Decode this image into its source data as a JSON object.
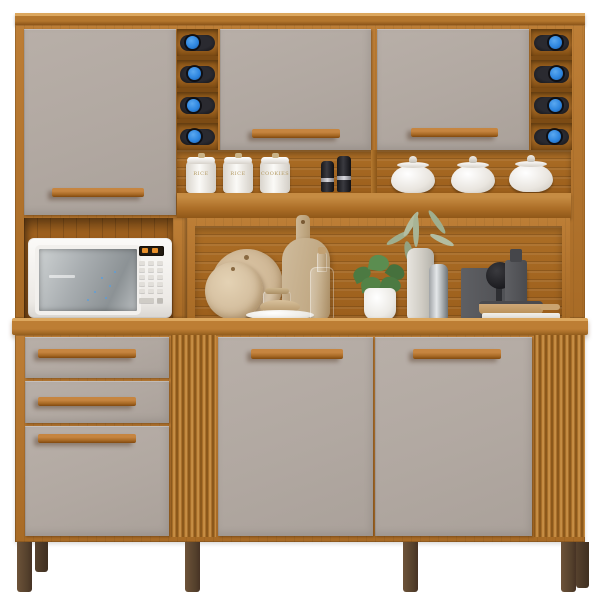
{
  "scene": {
    "type": "furniture product photo",
    "subject": "Kitchen hutch cabinet with wine racks, microwave niche and decor",
    "background_color": "#ffffff"
  },
  "palette": {
    "wood": "#ae7029",
    "wood_light": "#d39c52",
    "wood_dark": "#7d4e16",
    "front_gray": "#b1a8a1",
    "handle_wood": "#a96a26",
    "leg_brown": "#54402c",
    "wine_cap_blue": "#2e86e0",
    "ceramic_white": "#f5f3ef",
    "microwave_white": "#f4f2ef"
  },
  "counts": {
    "upper_doors": 3,
    "lower_doors": 2,
    "drawers": 3,
    "wine_bottles_left": 4,
    "wine_bottles_right": 4,
    "canisters": 3,
    "lidded_pots": 3,
    "spice_grinders": 2,
    "legs_visible": 6
  },
  "labels": {
    "canisters": [
      "RICE",
      "RICE",
      "COOKIES"
    ]
  },
  "decor_items": {
    "microwave": "white microwave oven",
    "boards": "round and paddle cutting boards",
    "bottle": "glass bottle with cork",
    "plate": "white plate with wooden bowl",
    "plant_green": "green plant in white pot",
    "plant_dried": "dried sage sprigs in tall vase",
    "steel_bottle": "stainless flask",
    "organizer": "dark utensil organizer with brush",
    "pan": "wooden serving pan on white board"
  }
}
